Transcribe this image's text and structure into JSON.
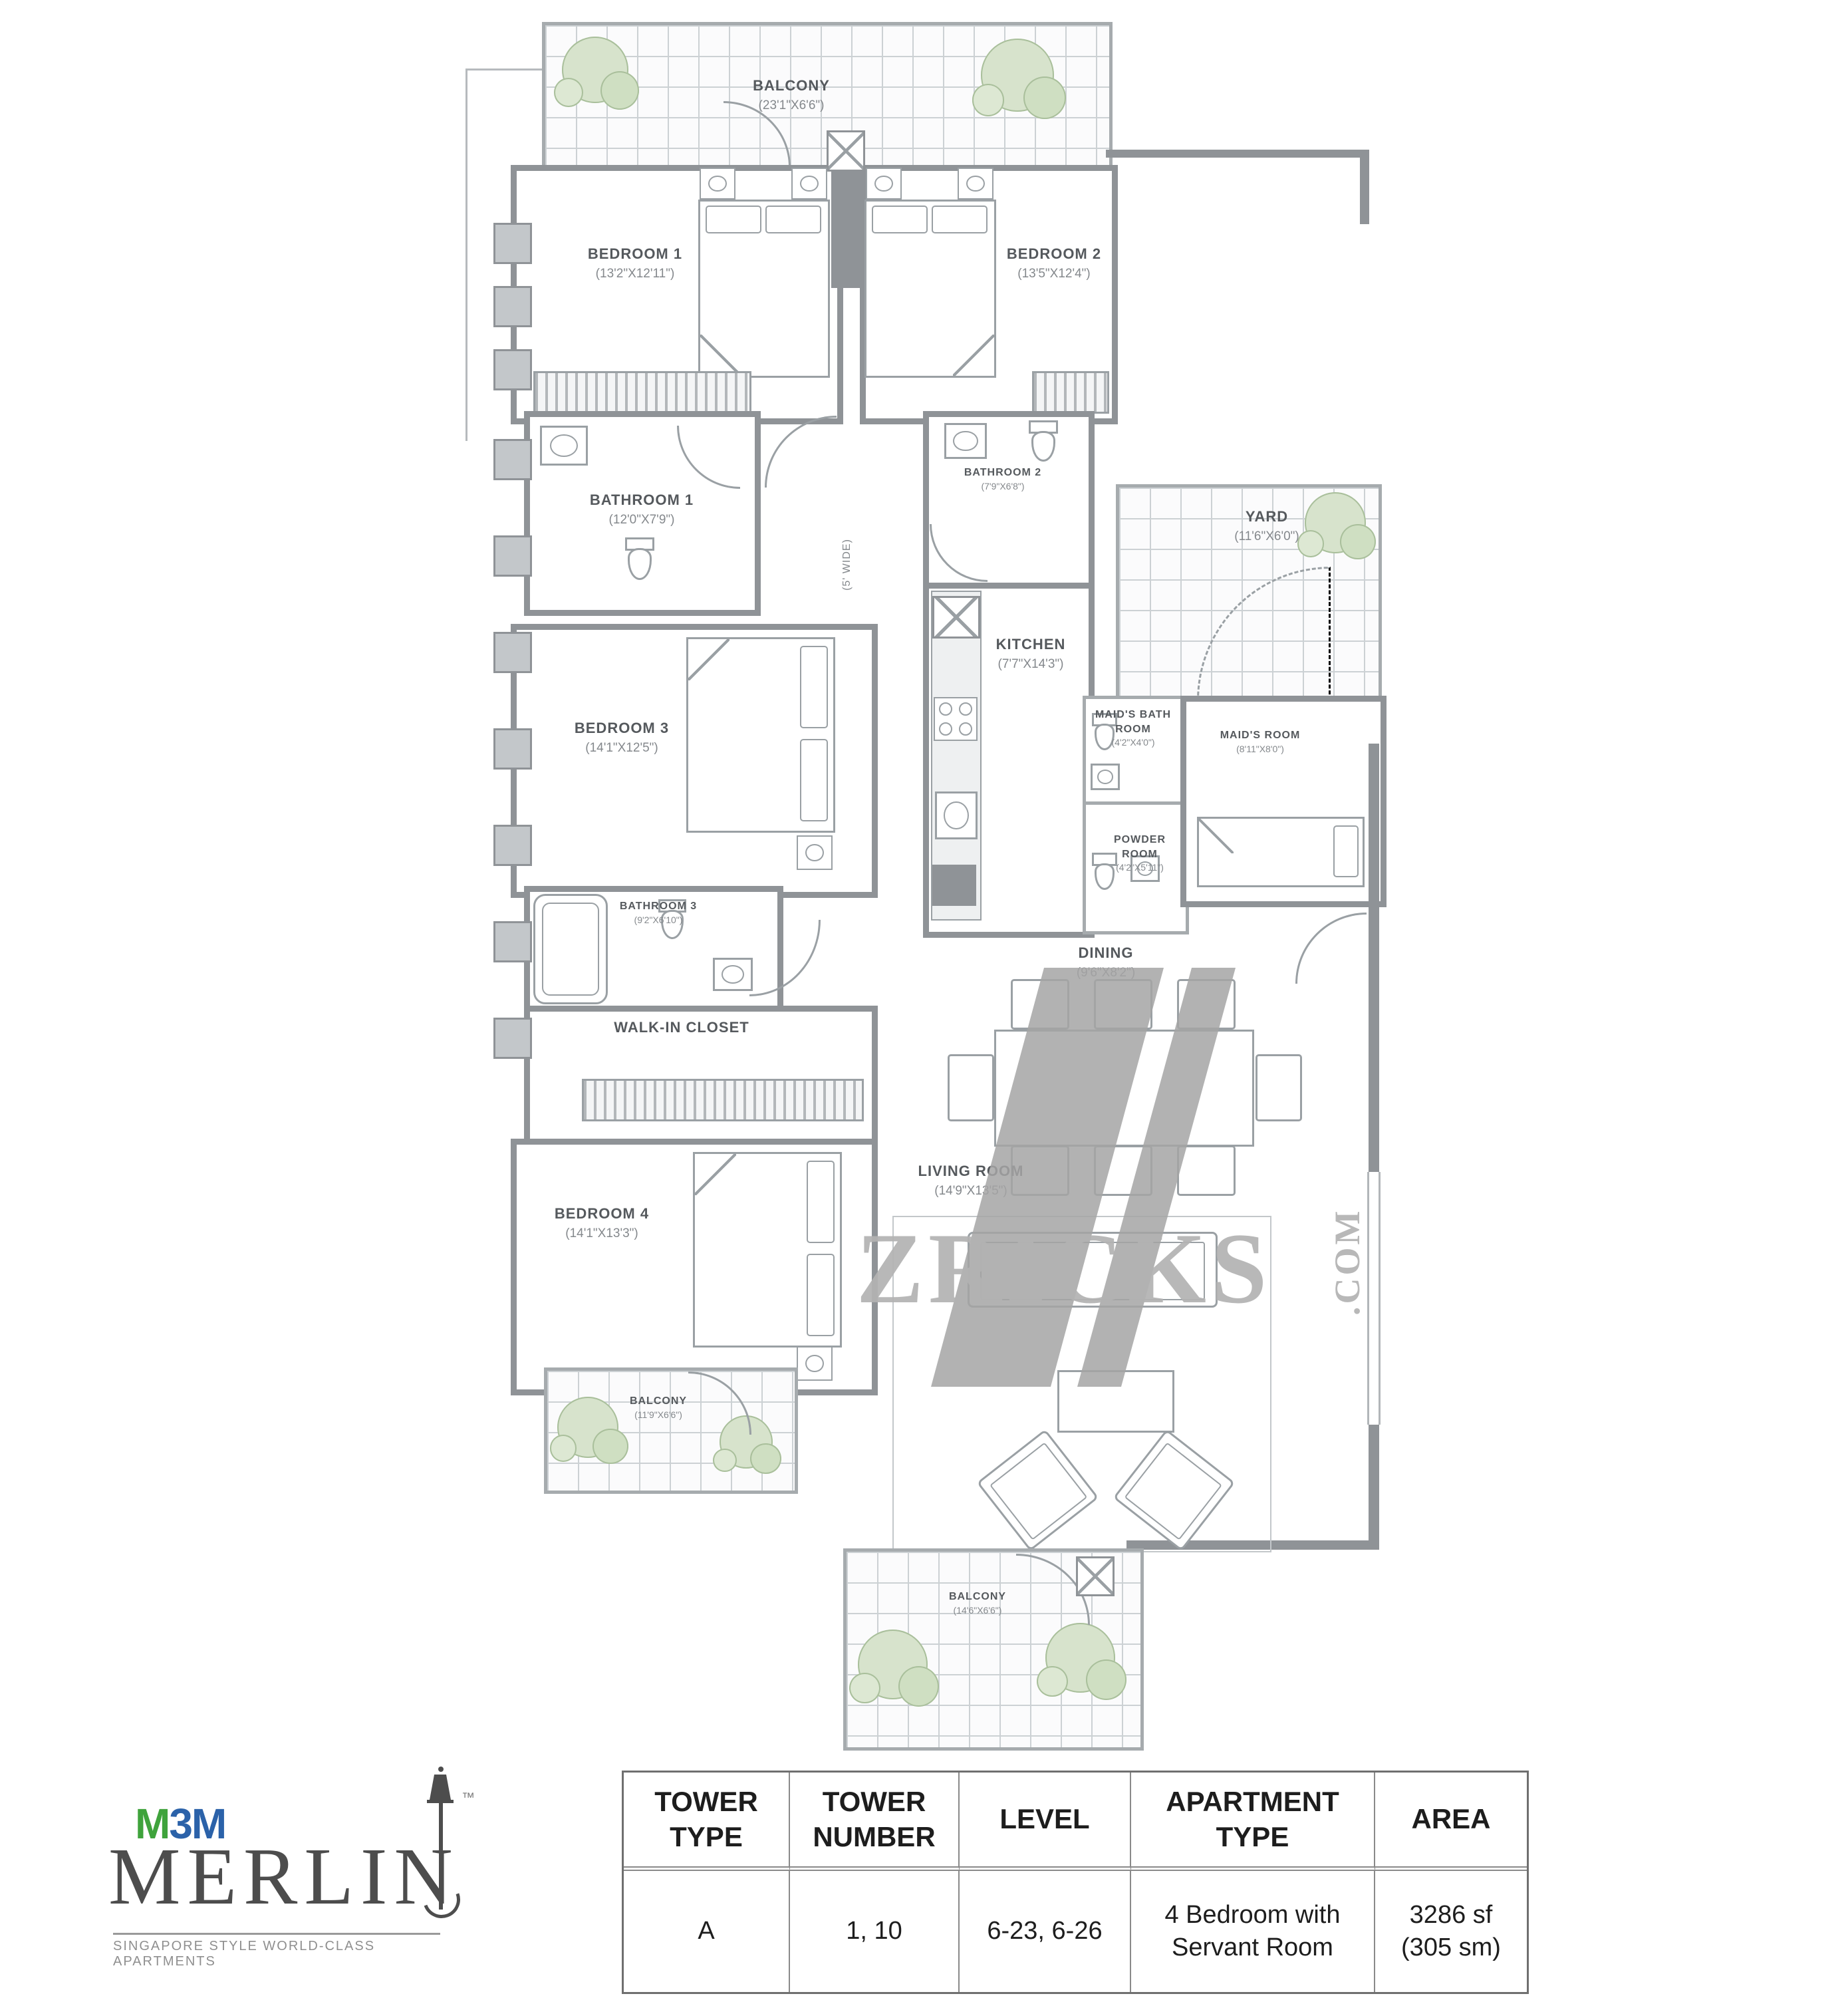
{
  "watermark": {
    "text": "ZRICKS",
    "suffix": ".COM"
  },
  "brand": {
    "m3m_m1": "M",
    "m3m_3": "3",
    "m3m_m2": "M",
    "tm": "™",
    "name": "MERLIN",
    "tagline": "SINGAPORE STYLE WORLD-CLASS APARTMENTS",
    "colors": {
      "green": "#3fa33c",
      "blue": "#2b62a9"
    }
  },
  "rooms": {
    "balcony_top": {
      "label": "BALCONY",
      "dims": "(23'1\"X6'6\")"
    },
    "bedroom1": {
      "label": "BEDROOM 1",
      "dims": "(13'2\"X12'11\")"
    },
    "bedroom2": {
      "label": "BEDROOM 2",
      "dims": "(13'5\"X12'4\")"
    },
    "bathroom1": {
      "label": "BATHROOM 1",
      "dims": "(12'0\"X7'9\")"
    },
    "bathroom2": {
      "label": "BATHROOM 2",
      "dims": "(7'9\"X6'8\")"
    },
    "yard": {
      "label": "YARD",
      "dims": "(11'6\"X6'0\")"
    },
    "kitchen": {
      "label": "KITCHEN",
      "dims": "(7'7\"X14'3\")"
    },
    "maids_bath": {
      "label": "MAID'S BATH ROOM",
      "dims": "(4'2\"X4'0\")"
    },
    "maids_room": {
      "label": "MAID'S ROOM",
      "dims": "(8'11\"X8'0\")"
    },
    "powder": {
      "label": "POWDER ROOM",
      "dims": "(4'2\"X5'11\")"
    },
    "bedroom3": {
      "label": "BEDROOM 3",
      "dims": "(14'1\"X12'5\")"
    },
    "bathroom3": {
      "label": "BATHROOM 3",
      "dims": "(9'2\"X6'10\")"
    },
    "walkin": {
      "label": "WALK-IN CLOSET",
      "dims": ""
    },
    "bedroom4": {
      "label": "BEDROOM 4",
      "dims": "(14'1\"X13'3\")"
    },
    "balcony_left": {
      "label": "BALCONY",
      "dims": "(11'9\"X6'6\")"
    },
    "dining": {
      "label": "DINING",
      "dims": "(9'6\"X8'2\")"
    },
    "living": {
      "label": "LIVING ROOM",
      "dims": "(14'9\"X13'5\")"
    },
    "balcony_bottom": {
      "label": "BALCONY",
      "dims": "(14'6\"X6'6\")"
    },
    "corridor_note": "(5' WIDE)"
  },
  "spec_table": {
    "headers": [
      "TOWER TYPE",
      "TOWER NUMBER",
      "LEVEL",
      "APARTMENT TYPE",
      "AREA"
    ],
    "row": {
      "tower_type": "A",
      "tower_number": "1, 10",
      "level": "6-23, 6-26",
      "apartment_type": "4 Bedroom with Servant Room",
      "area": "3286 sf (305 sm)"
    }
  }
}
